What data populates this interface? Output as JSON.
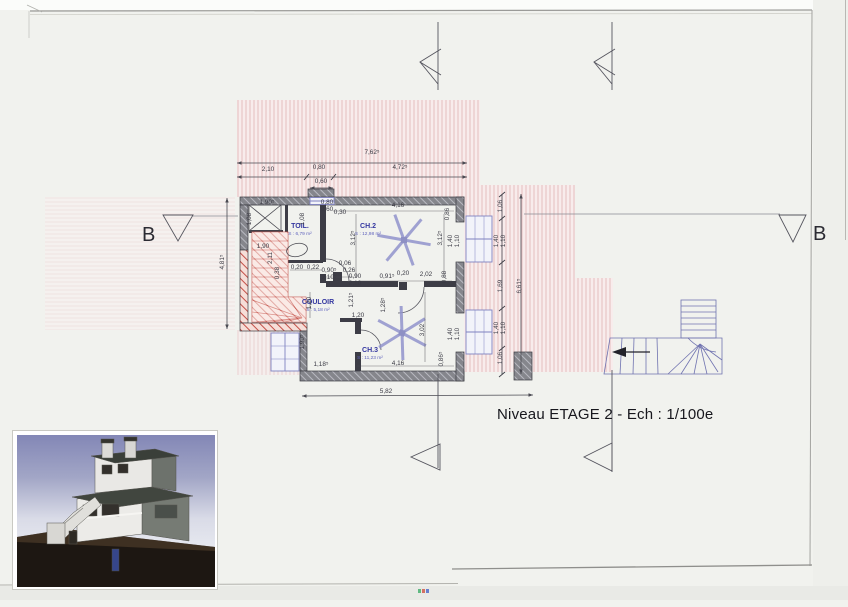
{
  "title": {
    "text": "Niveau ETAGE 2 - Ech : 1/100e"
  },
  "section_markers": {
    "left_label": "B",
    "right_label": "B"
  },
  "rooms": [
    {
      "name": "TOIL.",
      "area": "S : 6,79 m²",
      "x": 300,
      "y": 228
    },
    {
      "name": "CH.2",
      "area": "S : 12,98 m²",
      "x": 368,
      "y": 228
    },
    {
      "name": "COULOIR",
      "area": "S : 5,18 m²",
      "x": 318,
      "y": 304
    },
    {
      "name": "CH.3",
      "area": "S : 11,23 m²",
      "x": 370,
      "y": 352
    }
  ],
  "dimensions": [
    {
      "t": "7,62⁵",
      "x": 372,
      "y": 154
    },
    {
      "t": "2,10",
      "x": 268,
      "y": 171
    },
    {
      "t": "0,80",
      "x": 319,
      "y": 169
    },
    {
      "t": "4,72⁵",
      "x": 400,
      "y": 169
    },
    {
      "t": "0,60",
      "x": 321,
      "y": 183
    },
    {
      "t": "1,90⁵",
      "x": 267,
      "y": 204
    },
    {
      "t": "1,08",
      "x": 251,
      "y": 219,
      "r": 1
    },
    {
      "t": "1,08",
      "x": 304,
      "y": 219,
      "r": 1
    },
    {
      "t": "0,80",
      "x": 327,
      "y": 204
    },
    {
      "t": "0,60",
      "x": 327,
      "y": 211
    },
    {
      "t": "0,30",
      "x": 340,
      "y": 214
    },
    {
      "t": "4,16",
      "x": 398,
      "y": 207
    },
    {
      "t": "0,86",
      "x": 449,
      "y": 214,
      "r": 1
    },
    {
      "t": "3,12⁵",
      "x": 355,
      "y": 238,
      "r": 1
    },
    {
      "t": "3,12⁵",
      "x": 442,
      "y": 238,
      "r": 1
    },
    {
      "t": "1,40",
      "x": 452,
      "y": 241,
      "r": 1
    },
    {
      "t": "1,10",
      "x": 459,
      "y": 241,
      "r": 1
    },
    {
      "t": "1,90",
      "x": 263,
      "y": 248
    },
    {
      "t": "2,11",
      "x": 272,
      "y": 258,
      "r": 1
    },
    {
      "t": "0,38",
      "x": 279,
      "y": 273,
      "r": 1
    },
    {
      "t": "0,20",
      "x": 297,
      "y": 269
    },
    {
      "t": "0,22",
      "x": 313,
      "y": 269
    },
    {
      "t": "0,90⁵",
      "x": 329,
      "y": 272
    },
    {
      "t": "2,10⁵",
      "x": 329,
      "y": 279
    },
    {
      "t": "0,06",
      "x": 345,
      "y": 265
    },
    {
      "t": "0,26",
      "x": 349,
      "y": 272
    },
    {
      "t": "0,90",
      "x": 355,
      "y": 278
    },
    {
      "t": "2,10",
      "x": 355,
      "y": 285
    },
    {
      "t": "0,91⁵",
      "x": 387,
      "y": 278
    },
    {
      "t": "0,20",
      "x": 403,
      "y": 275
    },
    {
      "t": "2,02",
      "x": 426,
      "y": 276
    },
    {
      "t": "0,88",
      "x": 446,
      "y": 277,
      "r": 1
    },
    {
      "t": "1,20",
      "x": 311,
      "y": 303,
      "r": 1
    },
    {
      "t": "1,21⁵",
      "x": 353,
      "y": 300,
      "r": 1
    },
    {
      "t": "1,28⁵",
      "x": 385,
      "y": 305,
      "r": 1
    },
    {
      "t": "1,20",
      "x": 358,
      "y": 317
    },
    {
      "t": "3,02",
      "x": 424,
      "y": 330,
      "r": 1
    },
    {
      "t": "1,40",
      "x": 452,
      "y": 334,
      "r": 1
    },
    {
      "t": "1,10",
      "x": 459,
      "y": 334,
      "r": 1
    },
    {
      "t": "1,90⁵",
      "x": 304,
      "y": 342,
      "r": 1
    },
    {
      "t": "1,18⁵",
      "x": 321,
      "y": 366
    },
    {
      "t": "4,16",
      "x": 398,
      "y": 365
    },
    {
      "t": "0,86⁵",
      "x": 443,
      "y": 359,
      "r": 1
    },
    {
      "t": "5,82",
      "x": 386,
      "y": 393
    },
    {
      "t": "1,06",
      "x": 502,
      "y": 206,
      "r": 1
    },
    {
      "t": "1,40",
      "x": 498,
      "y": 241,
      "r": 1
    },
    {
      "t": "1,10",
      "x": 505,
      "y": 241,
      "r": 1
    },
    {
      "t": "1,69",
      "x": 502,
      "y": 286,
      "r": 1
    },
    {
      "t": "6,61⁵",
      "x": 521,
      "y": 286,
      "r": 1
    },
    {
      "t": "1,40",
      "x": 498,
      "y": 328,
      "r": 1
    },
    {
      "t": "1,10",
      "x": 505,
      "y": 328,
      "r": 1
    },
    {
      "t": "1,06",
      "x": 502,
      "y": 358,
      "r": 1
    },
    {
      "t": "4,81⁵",
      "x": 224,
      "y": 262,
      "r": 1
    }
  ],
  "colors": {
    "stair_red": "#c4524a",
    "hatch_pink": "#dfb3b3",
    "plan_blue": "#7f82c0",
    "wall_gray": "#85868c",
    "label_blue": "#3437a0"
  }
}
